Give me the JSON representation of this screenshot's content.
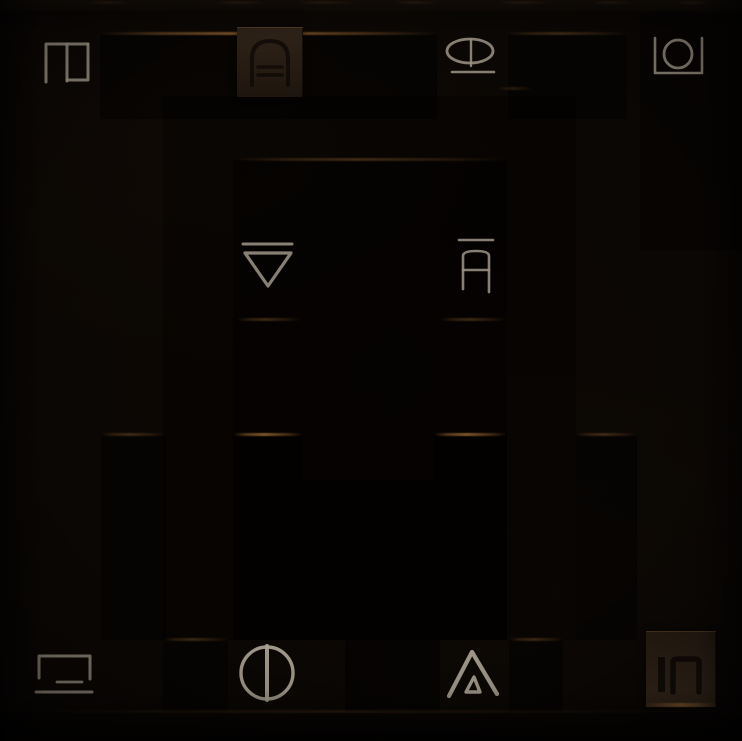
{
  "scene": {
    "kind": "dungeon-stone-wall-puzzle",
    "background_color": "#0B0704",
    "edge_highlight_color": "#8C5F30",
    "glyph_stroke_color": "#9A9183",
    "glyph_stroke_bright_color": "#ABA294",
    "carved_glyph_color": "#120C07",
    "tile_stone_color": "#2E2217"
  },
  "glyphs": [
    {
      "id": "gate-with-inner-bar",
      "position": "top-left",
      "approx_unicode": "⊓|",
      "style": "light-stroke-on-stone"
    },
    {
      "id": "arch-over-equals",
      "position": "top-center-left",
      "approx_unicode": "∩=",
      "style": "carved-into-raised-tile"
    },
    {
      "id": "eye-with-underline",
      "position": "top-center-right",
      "approx_unicode": "⊘_",
      "style": "light-stroke-on-stone"
    },
    {
      "id": "circle-in-open-box",
      "position": "top-right",
      "approx_unicode": "⊔○",
      "style": "light-stroke-on-stone"
    },
    {
      "id": "nabla-with-overline",
      "position": "middle-left",
      "approx_unicode": "⊽",
      "style": "light-stroke-on-stone"
    },
    {
      "id": "arch-crossbar-overline",
      "position": "middle-right",
      "approx_unicode": "Ā",
      "style": "light-stroke-on-stone"
    },
    {
      "id": "open-box-over-lines",
      "position": "bottom-left",
      "approx_unicode": "⊐=",
      "style": "light-stroke-on-stone"
    },
    {
      "id": "circle-vertical-line",
      "position": "bottom-center-left",
      "approx_unicode": "Φ",
      "style": "light-stroke-on-stone"
    },
    {
      "id": "mountain-inner-triangle",
      "position": "bottom-center-right",
      "approx_unicode": "◬",
      "style": "light-stroke-on-stone"
    },
    {
      "id": "bar-and-gate",
      "position": "bottom-right",
      "approx_unicode": "|∏",
      "style": "carved-into-raised-tile"
    }
  ]
}
